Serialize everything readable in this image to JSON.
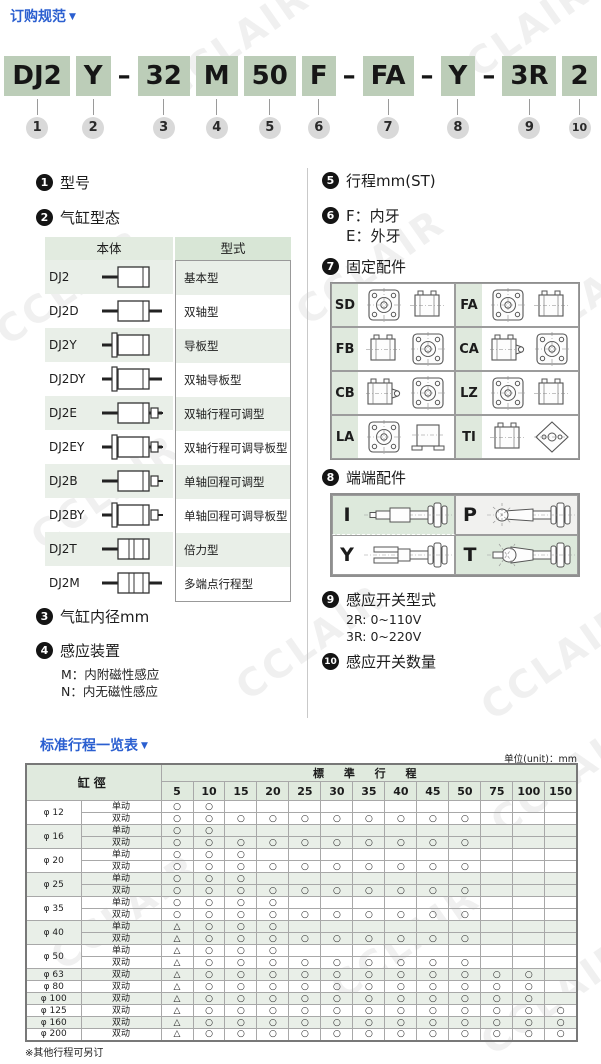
{
  "page": {
    "title": "订购规范",
    "watermark": "CCLAIR",
    "colors": {
      "accent_blue": "#2b5fd0",
      "model_box_green": "#bccdb8",
      "cell_green": "#dfe9dd",
      "row_alt_green": "#e9efe8",
      "number_circle_gray": "#d9d9d9",
      "section_circle_black": "#141414"
    }
  },
  "model_code": {
    "items": [
      {
        "label": "DJ2",
        "num": "1"
      },
      {
        "label": "Y",
        "num": "2"
      },
      {
        "sep": "–"
      },
      {
        "label": "32",
        "num": "3"
      },
      {
        "label": "M",
        "num": "4"
      },
      {
        "label": "50",
        "num": "5"
      },
      {
        "label": "F",
        "num": "6"
      },
      {
        "sep": "–"
      },
      {
        "label": "FA",
        "num": "7"
      },
      {
        "sep": "–"
      },
      {
        "label": "Y",
        "num": "8"
      },
      {
        "sep": "–"
      },
      {
        "label": "3R",
        "num": "9"
      },
      {
        "label": "2",
        "num": "10"
      }
    ]
  },
  "sections": {
    "s1": {
      "num": "1",
      "title": "型号"
    },
    "s2": {
      "num": "2",
      "title": "气缸型态",
      "table": {
        "headers": [
          "本体",
          "型式"
        ],
        "rows": [
          {
            "model": "DJ2",
            "type": "基本型",
            "icon": "cyl-basic"
          },
          {
            "model": "DJ2D",
            "type": "双轴型",
            "icon": "cyl-double-shaft"
          },
          {
            "model": "DJ2Y",
            "type": "导板型",
            "icon": "cyl-guide"
          },
          {
            "model": "DJ2DY",
            "type": "双轴导板型",
            "icon": "cyl-double-guide"
          },
          {
            "model": "DJ2E",
            "type": "双轴行程可调型",
            "icon": "cyl-double-adjust"
          },
          {
            "model": "DJ2EY",
            "type": "双轴行程可调导板型",
            "icon": "cyl-double-adjust-guide"
          },
          {
            "model": "DJ2B",
            "type": "单轴回程可调型",
            "icon": "cyl-single-adjust"
          },
          {
            "model": "DJ2BY",
            "type": "单轴回程可调导板型",
            "icon": "cyl-single-adjust-guide"
          },
          {
            "model": "DJ2T",
            "type": "倍力型",
            "icon": "cyl-tandem"
          },
          {
            "model": "DJ2M",
            "type": "多端点行程型",
            "icon": "cyl-multi-position"
          }
        ]
      }
    },
    "s3": {
      "num": "3",
      "title": "气缸内径mm"
    },
    "s4": {
      "num": "4",
      "title": "感应装置",
      "lines": [
        "M：内附磁性感应",
        "N：内无磁性感应"
      ]
    },
    "s5": {
      "num": "5",
      "title": "行程mm(ST)"
    },
    "s6": {
      "num": "6",
      "lines": [
        "F：内牙",
        "E：外牙"
      ]
    },
    "s7": {
      "num": "7",
      "title": "固定配件",
      "cells": [
        {
          "label": "SD",
          "views": [
            "front",
            "side"
          ]
        },
        {
          "label": "FA",
          "views": [
            "front",
            "side"
          ]
        },
        {
          "label": "FB",
          "views": [
            "side",
            "front"
          ]
        },
        {
          "label": "CA",
          "views": [
            "side-clevis",
            "front"
          ]
        },
        {
          "label": "CB",
          "views": [
            "side-clevis",
            "front"
          ]
        },
        {
          "label": "LZ",
          "views": [
            "front",
            "side"
          ]
        },
        {
          "label": "LA",
          "views": [
            "front",
            "side-base"
          ]
        },
        {
          "label": "TI",
          "views": [
            "side",
            "diamond"
          ]
        }
      ]
    },
    "s8": {
      "num": "8",
      "title": "端端配件",
      "cells": [
        {
          "label": "I",
          "icon": "rod-end-plain",
          "bg": "#dde9dc"
        },
        {
          "label": "P",
          "icon": "rod-end-ball",
          "bg": "#f1f1ef"
        },
        {
          "label": "Y",
          "icon": "rod-end-fork",
          "bg": "#ffffff"
        },
        {
          "label": "T",
          "icon": "rod-end-ball-joint",
          "bg": "#dde9dc"
        }
      ]
    },
    "s9": {
      "num": "9",
      "title": "感应开关型式",
      "lines": [
        "2R: 0~110V",
        "3R: 0~220V"
      ]
    },
    "s10": {
      "num": "10",
      "title": "感应开关数量"
    }
  },
  "stroke_section": {
    "title": "标准行程一览表",
    "unit_note": "单位(unit)：mm",
    "footnote": "※其他行程可另订"
  },
  "stroke_table": {
    "corner_header": "缸徑",
    "group_header": "標 準 行 程",
    "stroke_columns": [
      "5",
      "10",
      "15",
      "20",
      "25",
      "30",
      "35",
      "40",
      "45",
      "50",
      "75",
      "100",
      "150"
    ],
    "rows": [
      {
        "bore": "φ 12",
        "actions": [
          {
            "label": "单动",
            "marks": [
              "○",
              "○",
              "",
              "",
              "",
              "",
              "",
              "",
              "",
              "",
              "",
              "",
              ""
            ]
          },
          {
            "label": "双动",
            "marks": [
              "○",
              "○",
              "○",
              "○",
              "○",
              "○",
              "○",
              "○",
              "○",
              "○",
              "",
              "",
              ""
            ]
          }
        ]
      },
      {
        "bore": "φ 16",
        "actions": [
          {
            "label": "单动",
            "marks": [
              "○",
              "○",
              "",
              "",
              "",
              "",
              "",
              "",
              "",
              "",
              "",
              "",
              ""
            ]
          },
          {
            "label": "双动",
            "marks": [
              "○",
              "○",
              "○",
              "○",
              "○",
              "○",
              "○",
              "○",
              "○",
              "○",
              "",
              "",
              ""
            ]
          }
        ]
      },
      {
        "bore": "φ 20",
        "actions": [
          {
            "label": "单动",
            "marks": [
              "○",
              "○",
              "○",
              "",
              "",
              "",
              "",
              "",
              "",
              "",
              "",
              "",
              ""
            ]
          },
          {
            "label": "双动",
            "marks": [
              "○",
              "○",
              "○",
              "○",
              "○",
              "○",
              "○",
              "○",
              "○",
              "○",
              "",
              "",
              ""
            ]
          }
        ]
      },
      {
        "bore": "φ 25",
        "actions": [
          {
            "label": "单动",
            "marks": [
              "○",
              "○",
              "○",
              "",
              "",
              "",
              "",
              "",
              "",
              "",
              "",
              "",
              ""
            ]
          },
          {
            "label": "双动",
            "marks": [
              "○",
              "○",
              "○",
              "○",
              "○",
              "○",
              "○",
              "○",
              "○",
              "○",
              "",
              "",
              ""
            ]
          }
        ]
      },
      {
        "bore": "φ 35",
        "actions": [
          {
            "label": "单动",
            "marks": [
              "○",
              "○",
              "○",
              "○",
              "",
              "",
              "",
              "",
              "",
              "",
              "",
              "",
              ""
            ]
          },
          {
            "label": "双动",
            "marks": [
              "○",
              "○",
              "○",
              "○",
              "○",
              "○",
              "○",
              "○",
              "○",
              "○",
              "",
              "",
              ""
            ]
          }
        ]
      },
      {
        "bore": "φ 40",
        "actions": [
          {
            "label": "单动",
            "marks": [
              "△",
              "○",
              "○",
              "○",
              "",
              "",
              "",
              "",
              "",
              "",
              "",
              "",
              ""
            ]
          },
          {
            "label": "双动",
            "marks": [
              "△",
              "○",
              "○",
              "○",
              "○",
              "○",
              "○",
              "○",
              "○",
              "○",
              "",
              "",
              ""
            ]
          }
        ]
      },
      {
        "bore": "φ 50",
        "actions": [
          {
            "label": "单动",
            "marks": [
              "△",
              "○",
              "○",
              "○",
              "",
              "",
              "",
              "",
              "",
              "",
              "",
              "",
              ""
            ]
          },
          {
            "label": "双动",
            "marks": [
              "△",
              "○",
              "○",
              "○",
              "○",
              "○",
              "○",
              "○",
              "○",
              "○",
              "",
              "",
              ""
            ]
          }
        ]
      },
      {
        "bore": "φ 63",
        "actions": [
          {
            "label": "双动",
            "marks": [
              "△",
              "○",
              "○",
              "○",
              "○",
              "○",
              "○",
              "○",
              "○",
              "○",
              "○",
              "○",
              ""
            ]
          }
        ]
      },
      {
        "bore": "φ 80",
        "actions": [
          {
            "label": "双动",
            "marks": [
              "△",
              "○",
              "○",
              "○",
              "○",
              "○",
              "○",
              "○",
              "○",
              "○",
              "○",
              "○",
              ""
            ]
          }
        ]
      },
      {
        "bore": "φ 100",
        "actions": [
          {
            "label": "双动",
            "marks": [
              "△",
              "○",
              "○",
              "○",
              "○",
              "○",
              "○",
              "○",
              "○",
              "○",
              "○",
              "○",
              ""
            ]
          }
        ]
      },
      {
        "bore": "φ 125",
        "actions": [
          {
            "label": "双动",
            "marks": [
              "△",
              "○",
              "○",
              "○",
              "○",
              "○",
              "○",
              "○",
              "○",
              "○",
              "○",
              "○",
              "○"
            ]
          }
        ]
      },
      {
        "bore": "φ 160",
        "actions": [
          {
            "label": "双动",
            "marks": [
              "△",
              "○",
              "○",
              "○",
              "○",
              "○",
              "○",
              "○",
              "○",
              "○",
              "○",
              "○",
              "○"
            ]
          }
        ]
      },
      {
        "bore": "φ 200",
        "actions": [
          {
            "label": "双动",
            "marks": [
              "△",
              "○",
              "○",
              "○",
              "○",
              "○",
              "○",
              "○",
              "○",
              "○",
              "○",
              "○",
              "○"
            ]
          }
        ]
      }
    ]
  }
}
